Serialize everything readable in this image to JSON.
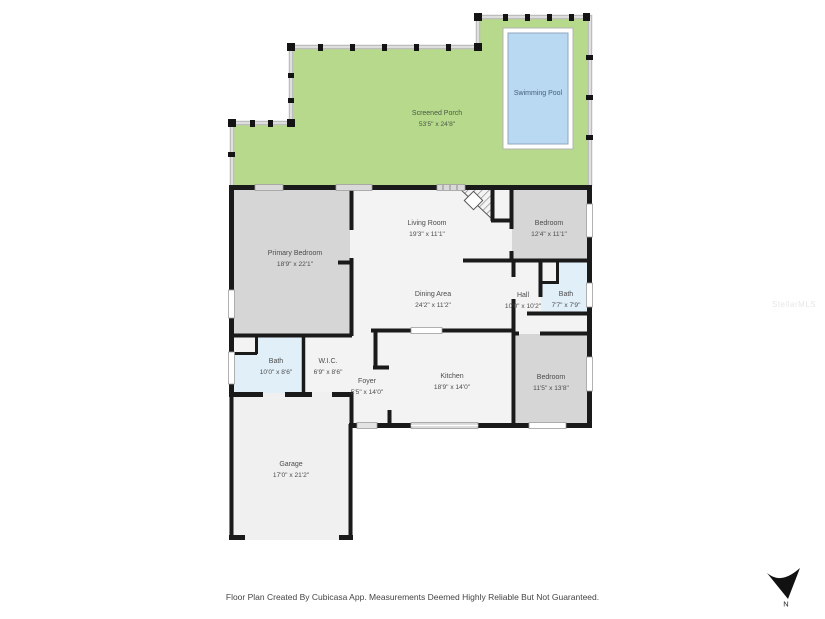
{
  "rooms": {
    "screened_porch": {
      "name": "Screened Porch",
      "dims": "53'5\" x 24'8\""
    },
    "swimming_pool": {
      "name": "Swimming Pool"
    },
    "primary_bedroom": {
      "name": "Primary Bedroom",
      "dims": "18'9\" x 22'1\""
    },
    "living_room": {
      "name": "Living Room",
      "dims": "19'3\" x 11'1\""
    },
    "bedroom_top_right": {
      "name": "Bedroom",
      "dims": "12'4\" x 11'1\""
    },
    "dining_area": {
      "name": "Dining Area",
      "dims": "24'2\" x 11'2\""
    },
    "hall": {
      "name": "Hall",
      "dims": "10'0\" x 10'2\""
    },
    "bath_right": {
      "name": "Bath",
      "dims": "7'7\" x 7'9\""
    },
    "bath_left": {
      "name": "Bath",
      "dims": "10'0\" x 8'6\""
    },
    "walk_in_closet": {
      "name": "W.I.C.",
      "dims": "6'9\" x 8'6\""
    },
    "foyer": {
      "name": "Foyer",
      "dims": "5'5\" x 14'0\""
    },
    "kitchen": {
      "name": "Kitchen",
      "dims": "18'9\" x 14'0\""
    },
    "bedroom_bottom_right": {
      "name": "Bedroom",
      "dims": "11'5\" x 13'8\""
    },
    "garage": {
      "name": "Garage",
      "dims": "17'0\" x 21'2\""
    }
  },
  "compass": {
    "label": "N"
  },
  "watermark": {
    "text": "StellarMLS"
  },
  "footer": {
    "disclaimer": "Floor Plan Created By Cubicasa App. Measurements Deemed Highly Reliable But Not Guaranteed."
  },
  "colors": {
    "porch_green": "#b6d98c",
    "pool_blue": "#b9d8f1",
    "room_gray": "#d6d6d6",
    "bath_blue": "#e1eff9",
    "floor_white": "#f3f3f3",
    "wall_black": "#1a1a1a"
  }
}
